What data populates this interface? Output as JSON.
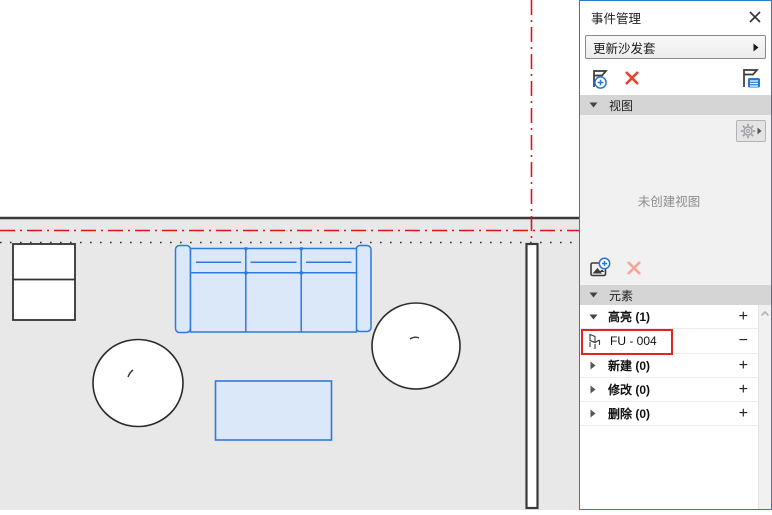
{
  "panel": {
    "title": "事件管理",
    "event_selector": {
      "value": "更新沙发套"
    },
    "sections": {
      "view": {
        "label": "视图",
        "empty_text": "未创建视图"
      },
      "element": {
        "label": "元素"
      }
    },
    "groups": [
      {
        "label": "高亮 (1)",
        "count": 1,
        "expanded": true
      },
      {
        "label": "新建 (0)",
        "count": 0,
        "expanded": false
      },
      {
        "label": "修改 (0)",
        "count": 0,
        "expanded": false
      },
      {
        "label": "删除 (0)",
        "count": 0,
        "expanded": false
      }
    ],
    "highlight_item": {
      "label": "FU - 004"
    }
  },
  "symbols": {
    "add": "+",
    "remove": "−"
  },
  "icons": [
    "close-icon",
    "dropdown-arrow-icon",
    "add-event-icon",
    "delete-event-icon",
    "event-details-icon",
    "gear-icon",
    "flyout-arrow-icon",
    "add-view-icon",
    "delete-view-icon",
    "collapse-triangle-icon",
    "expand-triangle-icon",
    "chair-icon",
    "scroll-up-icon"
  ],
  "colors": {
    "panel_border": "#2a7ad4",
    "section_header_bg": "#d5d5d5",
    "room_bg": "#e8e8e8",
    "reference_line_red": "#e01414",
    "selection_blue": "#3078d9",
    "selection_fill": "#dbe8f9",
    "annotation_red": "#e0251c",
    "delete_red": "#e8432d",
    "delete_disabled_pink": "#f2a698"
  }
}
